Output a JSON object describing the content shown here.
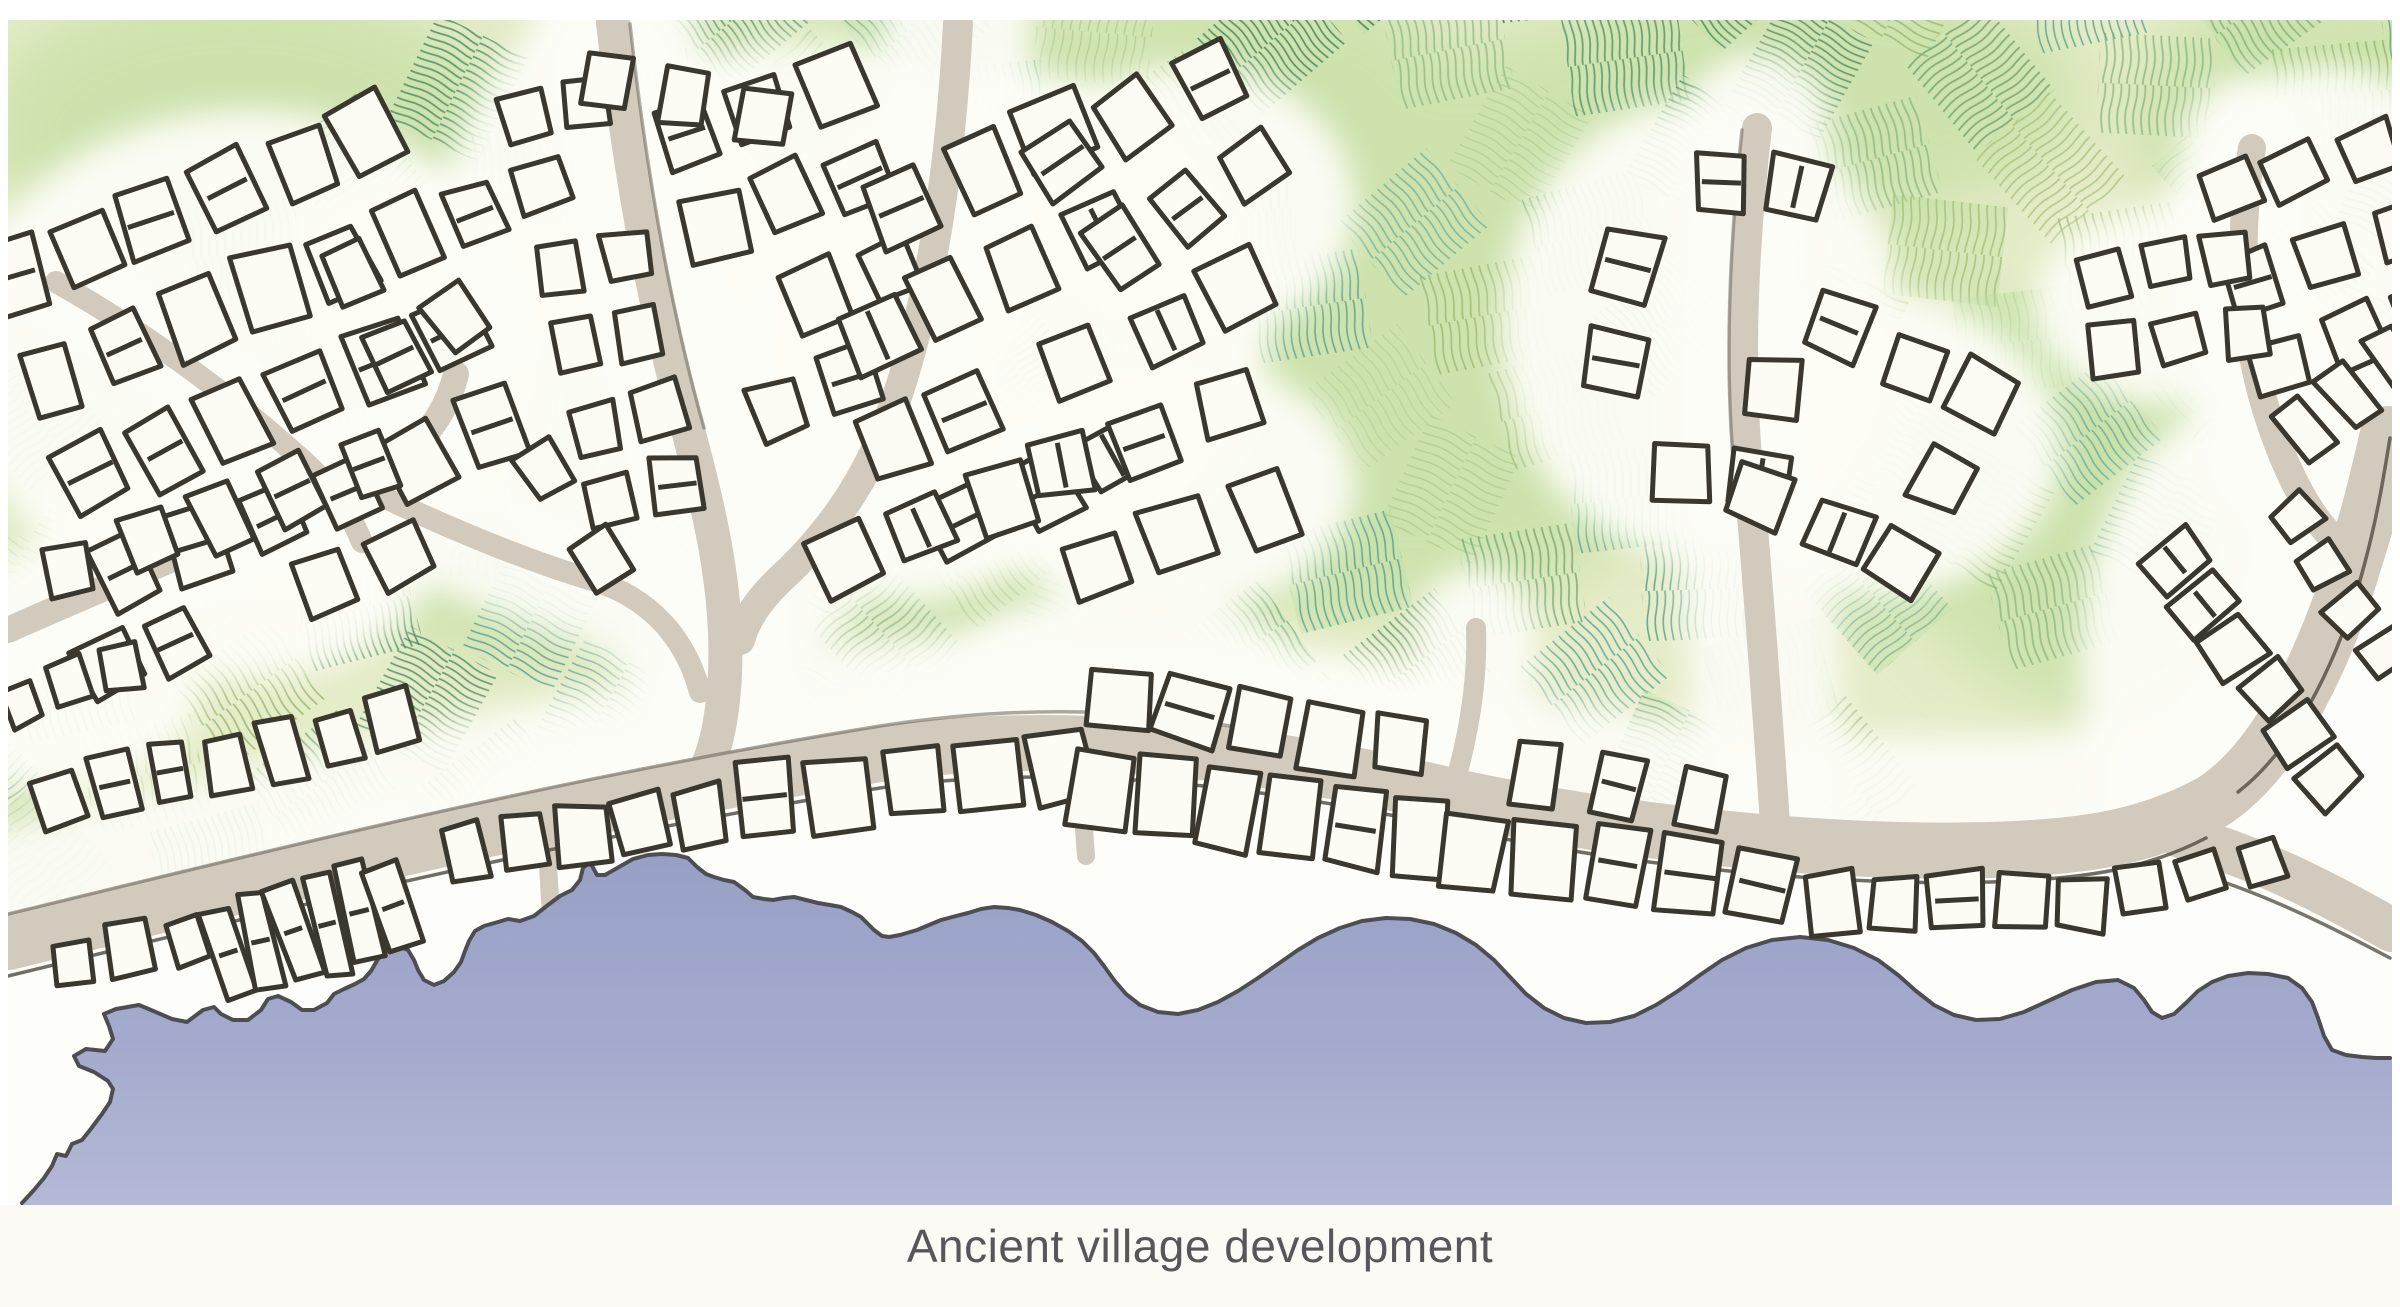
{
  "caption": {
    "text": "Ancient village development"
  },
  "palette": {
    "page_bg": "#ffffff",
    "caption_strip": "#fbfaf5",
    "caption_text": "#57575a",
    "field_base": "#e5ecc8",
    "field_wash": "#c4dfa3",
    "halo": "#fdfdf7",
    "beach": "#fdfdf9",
    "road": "#d2cabd",
    "road_edge": "#59544a",
    "building_fill": "#fcfcf5",
    "building_stroke": "#3a372f",
    "coast_line": "#4f4d54",
    "sea_top": "#98a0c6",
    "sea_mid": "#a5abce",
    "sea_bottom": "#b5b9d6"
  },
  "map": {
    "x": 8,
    "y": 20,
    "w": 2384,
    "h": 1185,
    "bottom": 1205
  },
  "field": {
    "angle": -38,
    "cell_w": 116,
    "cell_h": 100,
    "gap_u": 18,
    "gap_v": 16,
    "nx": 26,
    "ny": 13,
    "cx": 1150,
    "cy": 430,
    "extra_angles": [
      34,
      42,
      26,
      0,
      88,
      -24
    ],
    "patterns": [
      {
        "color": "#74a876",
        "tile": 8,
        "width": 1.8
      },
      {
        "color": "#4f9168",
        "tile": 7.5,
        "width": 1.8
      },
      {
        "color": "#58a093",
        "tile": 8,
        "width": 1.6
      },
      {
        "color": "#98b96d",
        "tile": 8.5,
        "width": 1.7
      },
      {
        "color": "#aecf94",
        "tile": 9,
        "width": 1.5
      },
      {
        "color": "#3f815c",
        "tile": 7,
        "width": 1.7
      }
    ],
    "boundary": [
      [
        8,
        20
      ],
      [
        2392,
        20
      ],
      [
        2392,
        432
      ],
      [
        2354,
        562
      ],
      [
        2318,
        668
      ],
      [
        2255,
        773
      ],
      [
        2190,
        822
      ],
      [
        2090,
        848
      ],
      [
        1990,
        852
      ],
      [
        1840,
        856
      ],
      [
        1640,
        840
      ],
      [
        1460,
        800
      ],
      [
        1260,
        752
      ],
      [
        1060,
        732
      ],
      [
        880,
        758
      ],
      [
        560,
        812
      ],
      [
        280,
        882
      ],
      [
        8,
        948
      ]
    ]
  },
  "washes": [
    [
      700,
      240,
      300,
      220
    ],
    [
      1420,
      360,
      300,
      250
    ],
    [
      2140,
      500,
      260,
      220
    ],
    [
      240,
      130,
      260,
      150
    ],
    [
      1800,
      95,
      280,
      130
    ],
    [
      1060,
      570,
      220,
      150
    ],
    [
      2320,
      120,
      190,
      130
    ],
    [
      520,
      530,
      180,
      130
    ],
    [
      1600,
      180,
      220,
      160
    ],
    [
      960,
      120,
      200,
      140
    ],
    [
      140,
      420,
      180,
      140
    ],
    [
      1260,
      90,
      200,
      120
    ]
  ],
  "halo_ellipses": [
    [
      250,
      360,
      300,
      250
    ],
    [
      430,
      285,
      150,
      110
    ],
    [
      610,
      300,
      180,
      300
    ],
    [
      805,
      250,
      240,
      210
    ],
    [
      1010,
      320,
      260,
      250
    ],
    [
      1165,
      485,
      190,
      130
    ],
    [
      1185,
      205,
      170,
      140
    ],
    [
      905,
      482,
      170,
      120
    ],
    [
      1700,
      330,
      200,
      230
    ],
    [
      1872,
      446,
      190,
      150
    ],
    [
      2326,
      255,
      170,
      190
    ],
    [
      2172,
      305,
      140,
      100
    ],
    [
      2250,
      660,
      170,
      260
    ],
    [
      2150,
      898,
      160,
      90
    ],
    [
      1120,
      700,
      200,
      110
    ],
    [
      1300,
      772,
      240,
      120
    ],
    [
      230,
      562,
      200,
      120
    ],
    [
      640,
      838,
      200,
      120
    ],
    [
      912,
      798,
      220,
      130
    ],
    [
      396,
      928,
      180,
      120
    ],
    [
      2320,
      430,
      130,
      130
    ],
    [
      60,
      690,
      140,
      100
    ]
  ],
  "roads": [
    {
      "d": "M 8,942 C 280,876 560,806 880,754 C 1060,728 1260,750 1460,798 C 1640,836 1840,854 1990,850 C 2090,847 2150,836 2212,802 C 2282,758 2330,642 2354,562 C 2372,506 2380,468 2388,434",
      "w": 56
    },
    {
      "d": "M 2180,836 C 2255,856 2325,892 2392,930",
      "w": 44
    },
    {
      "d": "M 613,22 C 628,160 652,300 688,430 C 712,520 731,602 724,690 C 720,734 713,754 705,772",
      "w": 34
    },
    {
      "d": "M 958,24 C 952,140 938,258 906,368 C 882,452 846,516 788,572 C 766,592 748,612 740,640",
      "w": 30
    },
    {
      "d": "M 1757,128 C 1744,240 1738,358 1748,470 C 1757,572 1766,690 1776,838",
      "w": 30
    },
    {
      "d": "M 2252,148 C 2236,248 2242,352 2278,444 C 2302,508 2330,542 2362,562",
      "w": 28
    },
    {
      "d": "M 8,630 C 120,580 238,532 350,484 C 410,460 444,424 456,374",
      "w": 26
    },
    {
      "d": "M 56,282 C 138,328 224,390 298,456 C 330,484 350,512 362,542",
      "w": 22
    },
    {
      "d": "M 352,482 C 430,520 512,556 592,580 C 652,598 686,640 700,692",
      "w": 22
    },
    {
      "d": "M 1452,794 C 1468,738 1478,684 1476,628",
      "w": 20
    },
    {
      "d": "M 396,844 L 400,986",
      "w": 18
    },
    {
      "d": "M 546,832 L 552,932",
      "w": 18
    },
    {
      "d": "M 1078,748 L 1086,856",
      "w": 18
    }
  ],
  "road_edges": [
    {
      "d": "M 8,976 C 280,910 560,840 880,788 C 1060,762 1260,784 1460,830 C 1640,868 1840,886 1990,882 C 2090,879 2148,868 2206,838",
      "o": 0.85
    },
    {
      "d": "M 8,914 C 280,848 560,778 880,726 C 1010,706 1120,708 1230,726",
      "o": 0.5
    },
    {
      "d": "M 2238,792 C 2300,744 2342,650 2364,566 C 2378,514 2384,474 2390,438",
      "o": 0.85
    },
    {
      "d": "M 2186,870 C 2256,890 2322,922 2390,958",
      "o": 0.8
    },
    {
      "d": "M 1742,130 C 1730,240 1724,358 1734,470",
      "o": 0.45
    },
    {
      "d": "M 630,24 C 645,160 668,300 704,428",
      "o": 0.45
    }
  ],
  "coast": [
    [
      22,
      1203
    ],
    [
      34,
      1190
    ],
    [
      44,
      1178
    ],
    [
      52,
      1166
    ],
    [
      57,
      1154
    ],
    [
      66,
      1156
    ],
    [
      72,
      1144
    ],
    [
      82,
      1140
    ],
    [
      90,
      1130
    ],
    [
      102,
      1114
    ],
    [
      110,
      1102
    ],
    [
      113,
      1089
    ],
    [
      108,
      1081
    ],
    [
      94,
      1072
    ],
    [
      79,
      1066
    ],
    [
      74,
      1056
    ],
    [
      86,
      1049
    ],
    [
      105,
      1051
    ],
    [
      113,
      1039
    ],
    [
      109,
      1026
    ],
    [
      104,
      1014
    ],
    [
      116,
      1009
    ],
    [
      139,
      1005
    ],
    [
      151,
      1010
    ],
    [
      172,
      1019
    ],
    [
      187,
      1022
    ],
    [
      203,
      1010
    ],
    [
      214,
      1007
    ],
    [
      221,
      1014
    ],
    [
      233,
      1020
    ],
    [
      248,
      1020
    ],
    [
      261,
      1010
    ],
    [
      268,
      999
    ],
    [
      278,
      996
    ],
    [
      291,
      1002
    ],
    [
      302,
      1010
    ],
    [
      314,
      1010
    ],
    [
      327,
      1003
    ],
    [
      334,
      994
    ],
    [
      344,
      989
    ],
    [
      355,
      984
    ],
    [
      364,
      979
    ],
    [
      371,
      971
    ],
    [
      378,
      959
    ],
    [
      388,
      949
    ],
    [
      398,
      946
    ],
    [
      408,
      950
    ],
    [
      414,
      960
    ],
    [
      418,
      970
    ],
    [
      424,
      980
    ],
    [
      434,
      985
    ],
    [
      444,
      981
    ],
    [
      454,
      972
    ],
    [
      461,
      962
    ],
    [
      465,
      951
    ],
    [
      469,
      941
    ],
    [
      475,
      931
    ],
    [
      484,
      926
    ],
    [
      498,
      922
    ],
    [
      508,
      919
    ],
    [
      520,
      921
    ],
    [
      534,
      916
    ],
    [
      548,
      905
    ],
    [
      560,
      896
    ],
    [
      572,
      890
    ],
    [
      580,
      880
    ],
    [
      583,
      868
    ],
    [
      590,
      862
    ],
    [
      597,
      875
    ],
    [
      605,
      875
    ],
    [
      612,
      871
    ],
    [
      633,
      859
    ],
    [
      648,
      855
    ],
    [
      662,
      854
    ],
    [
      676,
      855
    ],
    [
      688,
      858
    ],
    [
      697,
      867
    ],
    [
      706,
      874
    ],
    [
      714,
      877
    ],
    [
      724,
      880
    ],
    [
      734,
      882
    ],
    [
      745,
      890
    ],
    [
      753,
      897
    ],
    [
      764,
      899
    ],
    [
      773,
      900
    ],
    [
      784,
      898
    ],
    [
      794,
      897
    ],
    [
      806,
      900
    ],
    [
      818,
      903
    ],
    [
      830,
      905
    ],
    [
      841,
      907
    ],
    [
      852,
      912
    ],
    [
      861,
      917
    ],
    [
      869,
      925
    ],
    [
      874,
      930
    ],
    [
      882,
      936
    ],
    [
      889,
      937
    ],
    [
      900,
      935
    ],
    [
      917,
      930
    ],
    [
      929,
      925
    ],
    [
      941,
      920
    ],
    [
      956,
      916
    ],
    [
      968,
      913
    ],
    [
      981,
      909
    ],
    [
      994,
      907
    ],
    [
      1008,
      908
    ],
    [
      1020,
      910
    ],
    [
      1036,
      915
    ],
    [
      1052,
      922
    ],
    [
      1068,
      931
    ],
    [
      1082,
      941
    ],
    [
      1094,
      953
    ],
    [
      1104,
      966
    ],
    [
      1114,
      980
    ],
    [
      1126,
      994
    ],
    [
      1140,
      1005
    ],
    [
      1158,
      1012
    ],
    [
      1178,
      1014
    ],
    [
      1198,
      1010
    ],
    [
      1218,
      1002
    ],
    [
      1238,
      991
    ],
    [
      1258,
      978
    ],
    [
      1278,
      964
    ],
    [
      1298,
      950
    ],
    [
      1318,
      938
    ],
    [
      1340,
      928
    ],
    [
      1362,
      921
    ],
    [
      1386,
      918
    ],
    [
      1410,
      919
    ],
    [
      1434,
      924
    ],
    [
      1456,
      933
    ],
    [
      1476,
      945
    ],
    [
      1494,
      960
    ],
    [
      1510,
      977
    ],
    [
      1526,
      994
    ],
    [
      1544,
      1008
    ],
    [
      1564,
      1018
    ],
    [
      1586,
      1023
    ],
    [
      1610,
      1022
    ],
    [
      1634,
      1016
    ],
    [
      1656,
      1005
    ],
    [
      1678,
      991
    ],
    [
      1700,
      975
    ],
    [
      1722,
      960
    ],
    [
      1746,
      948
    ],
    [
      1772,
      940
    ],
    [
      1800,
      937
    ],
    [
      1828,
      940
    ],
    [
      1854,
      948
    ],
    [
      1878,
      960
    ],
    [
      1898,
      975
    ],
    [
      1916,
      991
    ],
    [
      1934,
      1005
    ],
    [
      1954,
      1015
    ],
    [
      1976,
      1020
    ],
    [
      2000,
      1019
    ],
    [
      2024,
      1012
    ],
    [
      2048,
      1001
    ],
    [
      2072,
      990
    ],
    [
      2096,
      982
    ],
    [
      2118,
      980
    ],
    [
      2134,
      988
    ],
    [
      2144,
      1000
    ],
    [
      2152,
      1012
    ],
    [
      2162,
      1018
    ],
    [
      2174,
      1014
    ],
    [
      2186,
      1003
    ],
    [
      2198,
      991
    ],
    [
      2212,
      982
    ],
    [
      2228,
      976
    ],
    [
      2248,
      973
    ],
    [
      2268,
      974
    ],
    [
      2288,
      978
    ],
    [
      2302,
      988
    ],
    [
      2312,
      1002
    ],
    [
      2318,
      1018
    ],
    [
      2324,
      1036
    ],
    [
      2332,
      1050
    ],
    [
      2346,
      1055
    ],
    [
      2362,
      1057
    ],
    [
      2376,
      1058
    ],
    [
      2390,
      1058
    ]
  ],
  "clusters": [
    {
      "cx": 250,
      "cy": 355,
      "rows": 4,
      "cols": 6,
      "bw": 52,
      "bh": 66,
      "gx": 26,
      "gy": 40,
      "angle": -22,
      "skip": 0.15
    },
    {
      "cx": 235,
      "cy": 565,
      "rows": 2,
      "cols": 5,
      "bw": 48,
      "bh": 56,
      "gx": 30,
      "gy": 46,
      "angle": -20,
      "skip": 0.1
    },
    {
      "cx": 600,
      "cy": 300,
      "rows": 6,
      "cols": 2,
      "bw": 44,
      "bh": 50,
      "gx": 24,
      "gy": 30,
      "angle": -12,
      "skip": 0.12
    },
    {
      "cx": 805,
      "cy": 245,
      "rows": 4,
      "cols": 3,
      "bw": 52,
      "bh": 60,
      "gx": 26,
      "gy": 36,
      "angle": -18,
      "skip": 0.12
    },
    {
      "cx": 1010,
      "cy": 330,
      "rows": 4,
      "cols": 4,
      "bw": 56,
      "bh": 62,
      "gx": 28,
      "gy": 42,
      "angle": -26,
      "skip": 0.15
    },
    {
      "cx": 1165,
      "cy": 487,
      "rows": 2,
      "cols": 3,
      "bw": 58,
      "bh": 62,
      "gx": 30,
      "gy": 42,
      "angle": -18,
      "skip": 0
    },
    {
      "cx": 1185,
      "cy": 205,
      "rows": 3,
      "cols": 3,
      "bw": 52,
      "bh": 58,
      "gx": 28,
      "gy": 40,
      "angle": -30,
      "skip": 0.2
    },
    {
      "cx": 905,
      "cy": 485,
      "rows": 2,
      "cols": 3,
      "bw": 52,
      "bh": 58,
      "gx": 28,
      "gy": 38,
      "angle": -22,
      "skip": 0.1
    },
    {
      "cx": 432,
      "cy": 282,
      "rows": 2,
      "cols": 3,
      "bw": 44,
      "bh": 52,
      "gx": 24,
      "gy": 34,
      "angle": -28,
      "skip": 0.1
    },
    {
      "cx": 1702,
      "cy": 325,
      "rows": 4,
      "cols": 3,
      "bw": 54,
      "bh": 58,
      "gx": 26,
      "gy": 40,
      "angle": 8,
      "skip": 0.15
    },
    {
      "cx": 1872,
      "cy": 448,
      "rows": 3,
      "cols": 3,
      "bw": 52,
      "bh": 56,
      "gx": 26,
      "gy": 38,
      "angle": 25,
      "skip": 0.12
    },
    {
      "cx": 2326,
      "cy": 255,
      "rows": 3,
      "cols": 3,
      "bw": 50,
      "bh": 54,
      "gx": 26,
      "gy": 36,
      "angle": -18,
      "skip": 0.12
    },
    {
      "cx": 2172,
      "cy": 305,
      "rows": 2,
      "cols": 3,
      "bw": 42,
      "bh": 46,
      "gx": 24,
      "gy": 30,
      "angle": -10,
      "skip": 0
    }
  ],
  "strips": [
    {
      "x1": 60,
      "y1": 800,
      "x2": 392,
      "y2": 722,
      "n": 7,
      "bw": 42,
      "bh": 56
    },
    {
      "x1": 72,
      "y1": 958,
      "x2": 186,
      "y2": 936,
      "n": 3,
      "bw": 40,
      "bh": 48
    },
    {
      "x1": 228,
      "y1": 952,
      "x2": 392,
      "y2": 902,
      "n": 6,
      "bw": 30,
      "bh": 96
    },
    {
      "x1": 465,
      "y1": 852,
      "x2": 700,
      "y2": 812,
      "n": 5,
      "bw": 44,
      "bh": 60
    },
    {
      "x1": 765,
      "y1": 800,
      "x2": 1062,
      "y2": 768,
      "n": 5,
      "bw": 64,
      "bh": 76
    },
    {
      "x1": 1100,
      "y1": 792,
      "x2": 1420,
      "y2": 832,
      "n": 6,
      "bw": 60,
      "bh": 72
    },
    {
      "x1": 1472,
      "y1": 848,
      "x2": 1762,
      "y2": 888,
      "n": 5,
      "bw": 56,
      "bh": 66
    },
    {
      "x1": 1832,
      "y1": 906,
      "x2": 2082,
      "y2": 902,
      "n": 5,
      "bw": 48,
      "bh": 56
    },
    {
      "x1": 1120,
      "y1": 696,
      "x2": 1400,
      "y2": 748,
      "n": 5,
      "bw": 54,
      "bh": 62
    },
    {
      "x1": 1536,
      "y1": 772,
      "x2": 1700,
      "y2": 806,
      "n": 3,
      "bw": 50,
      "bh": 56
    },
    {
      "x1": 2172,
      "y1": 562,
      "x2": 2330,
      "y2": 778,
      "n": 6,
      "bw": 44,
      "bh": 52
    },
    {
      "x1": 2292,
      "y1": 520,
      "x2": 2386,
      "y2": 652,
      "n": 4,
      "bw": 40,
      "bh": 46
    },
    {
      "x1": 2302,
      "y1": 428,
      "x2": 2390,
      "y2": 356,
      "n": 3,
      "bw": 36,
      "bh": 56
    },
    {
      "x1": 2142,
      "y1": 892,
      "x2": 2262,
      "y2": 862,
      "n": 3,
      "bw": 40,
      "bh": 44
    },
    {
      "x1": 604,
      "y1": 84,
      "x2": 762,
      "y2": 118,
      "n": 3,
      "bw": 46,
      "bh": 50
    },
    {
      "x1": 544,
      "y1": 470,
      "x2": 600,
      "y2": 560,
      "n": 2,
      "bw": 44,
      "bh": 48
    },
    {
      "x1": 20,
      "y1": 700,
      "x2": 120,
      "y2": 668,
      "n": 3,
      "bw": 36,
      "bh": 44
    }
  ]
}
